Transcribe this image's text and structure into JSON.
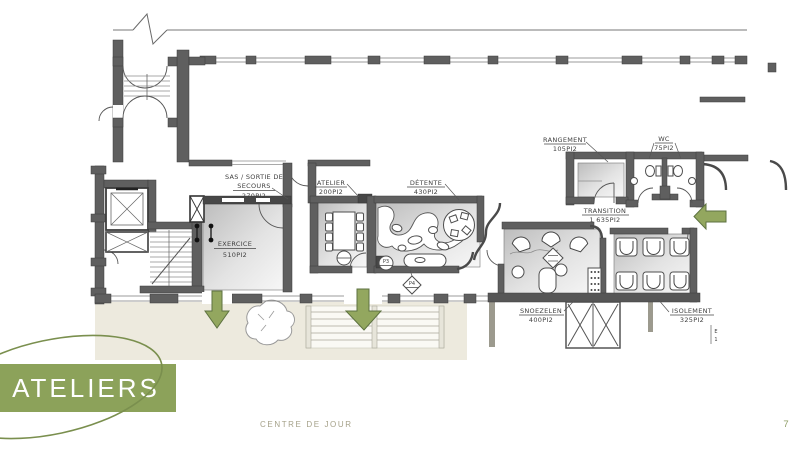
{
  "page": {
    "footer_text": "CENTRE DE JOUR",
    "page_number": "7"
  },
  "badge": {
    "label": "ATELIERS"
  },
  "rooms": {
    "sas": {
      "name_line1": "SAS / SORTIE DE",
      "name_line2": "SECOURS",
      "area": "270PI2"
    },
    "atelier": {
      "name": "ATELIER",
      "area": "200PI2"
    },
    "detente": {
      "name": "DÉTENTE",
      "area": "430PI2"
    },
    "exercice": {
      "name": "EXERCICE",
      "area": "510PI2"
    },
    "rangement": {
      "name": "RANGEMENT",
      "area": "105PI2"
    },
    "wc": {
      "name": "WC",
      "area": "75PI2"
    },
    "transition": {
      "name": "TRANSITION",
      "area": "1 635PI2"
    },
    "snoezelen": {
      "name": "SNOEZELEN",
      "area": "400PI2"
    },
    "isolement": {
      "name": "ISOLEMENT",
      "area": "325PI2"
    }
  },
  "markers": {
    "p3": "P3",
    "p4": "P4",
    "section_line1": "E",
    "section_line2": "1"
  },
  "colors": {
    "accent_green": "#93a75f",
    "accent_green_dark": "#5d7240",
    "badge_green": "#8ca25a",
    "sketch_green": "#7a8f4e",
    "footer_text": "#a5a189",
    "page_number": "#8d9c63"
  }
}
